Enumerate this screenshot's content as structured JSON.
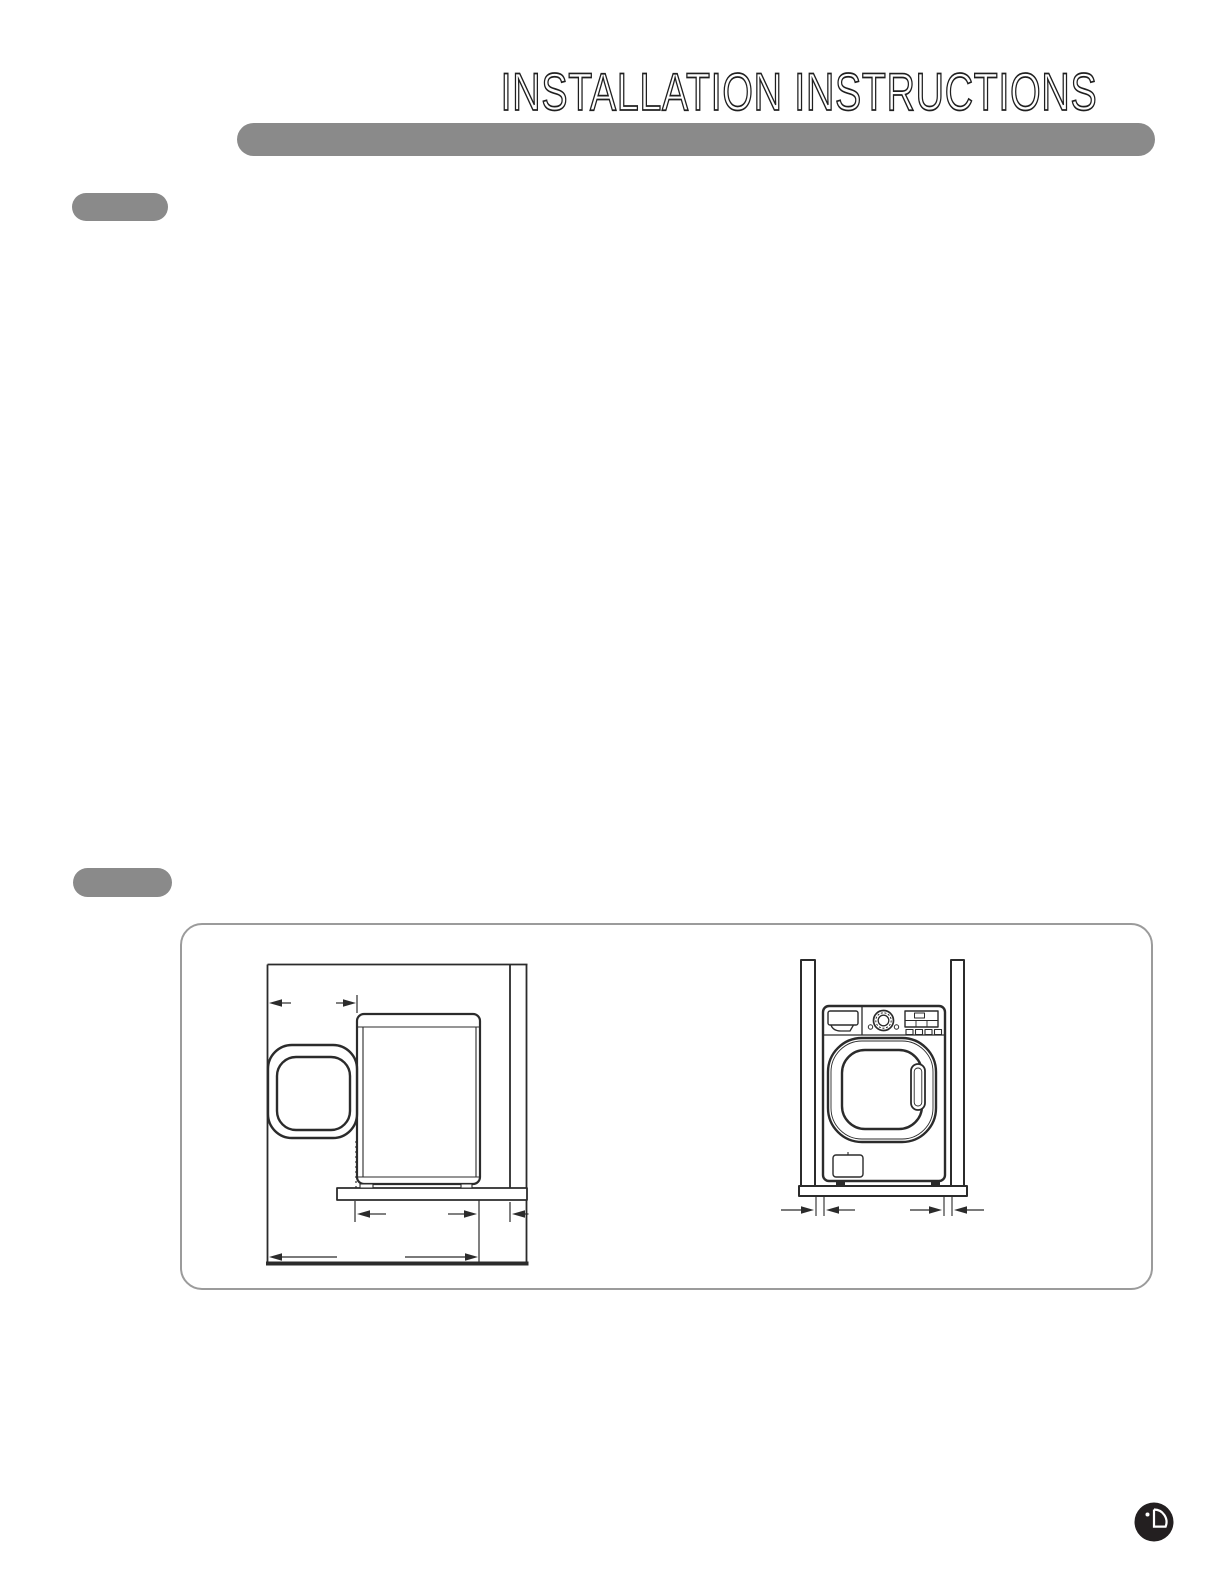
{
  "page": {
    "title": "INSTALLATION INSTRUCTIONS"
  },
  "header": {
    "bar_color": "#8a8a8a"
  },
  "section_markers": {
    "count": 2,
    "color": "#8a8a8a"
  },
  "figure": {
    "border_color": "#9b9b9b",
    "diagrams": [
      {
        "id": "side-view",
        "icon": "dryer-side-view-open-door-clearance-diagram"
      },
      {
        "id": "front-view",
        "icon": "dryer-front-view-between-walls-clearance-diagram"
      }
    ]
  },
  "footer": {
    "logo_icon": "lg-logo"
  },
  "colors": {
    "ink": "#2b2b2b",
    "gray": "#8a8a8a",
    "box_border": "#9b9b9b",
    "logo": "#231f20",
    "background": "#ffffff"
  }
}
